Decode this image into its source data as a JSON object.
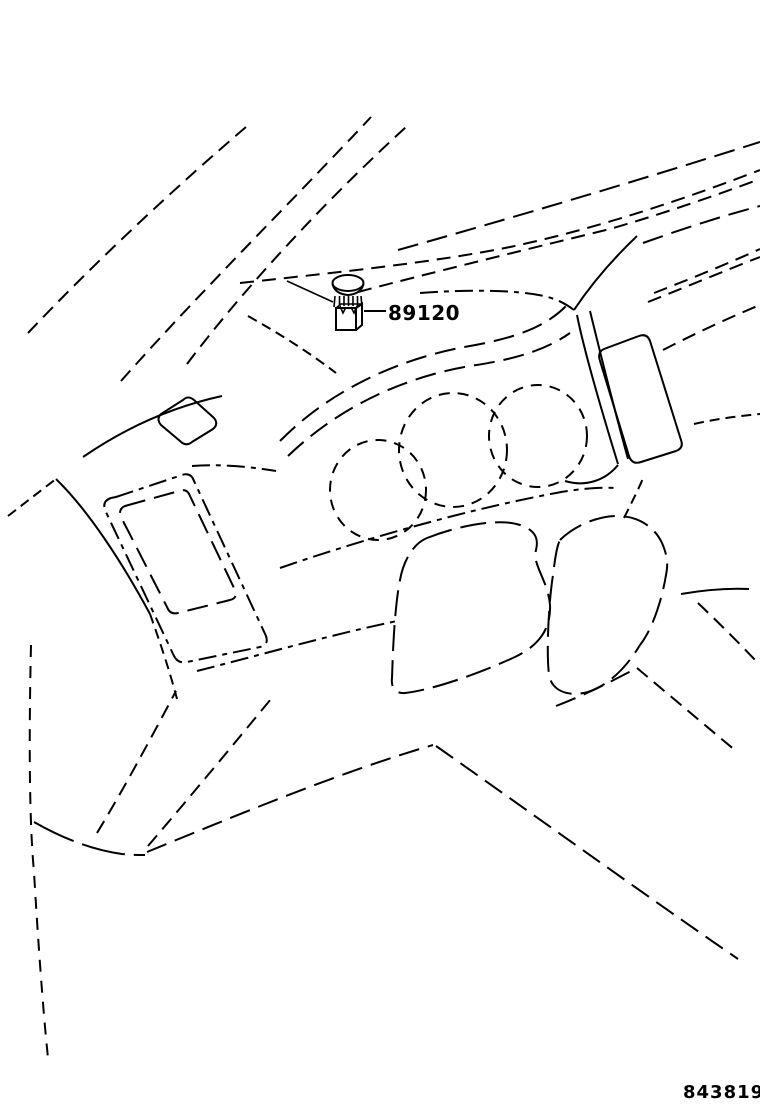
{
  "labels": {
    "part_number": "89120",
    "figure_number": "843819"
  },
  "diagram": {
    "subject": "instrument-panel-line-illustration",
    "part_icon": "dome-cap-sensor-plug-icon",
    "colors": {
      "line": "#000000",
      "background": "#ffffff"
    }
  }
}
